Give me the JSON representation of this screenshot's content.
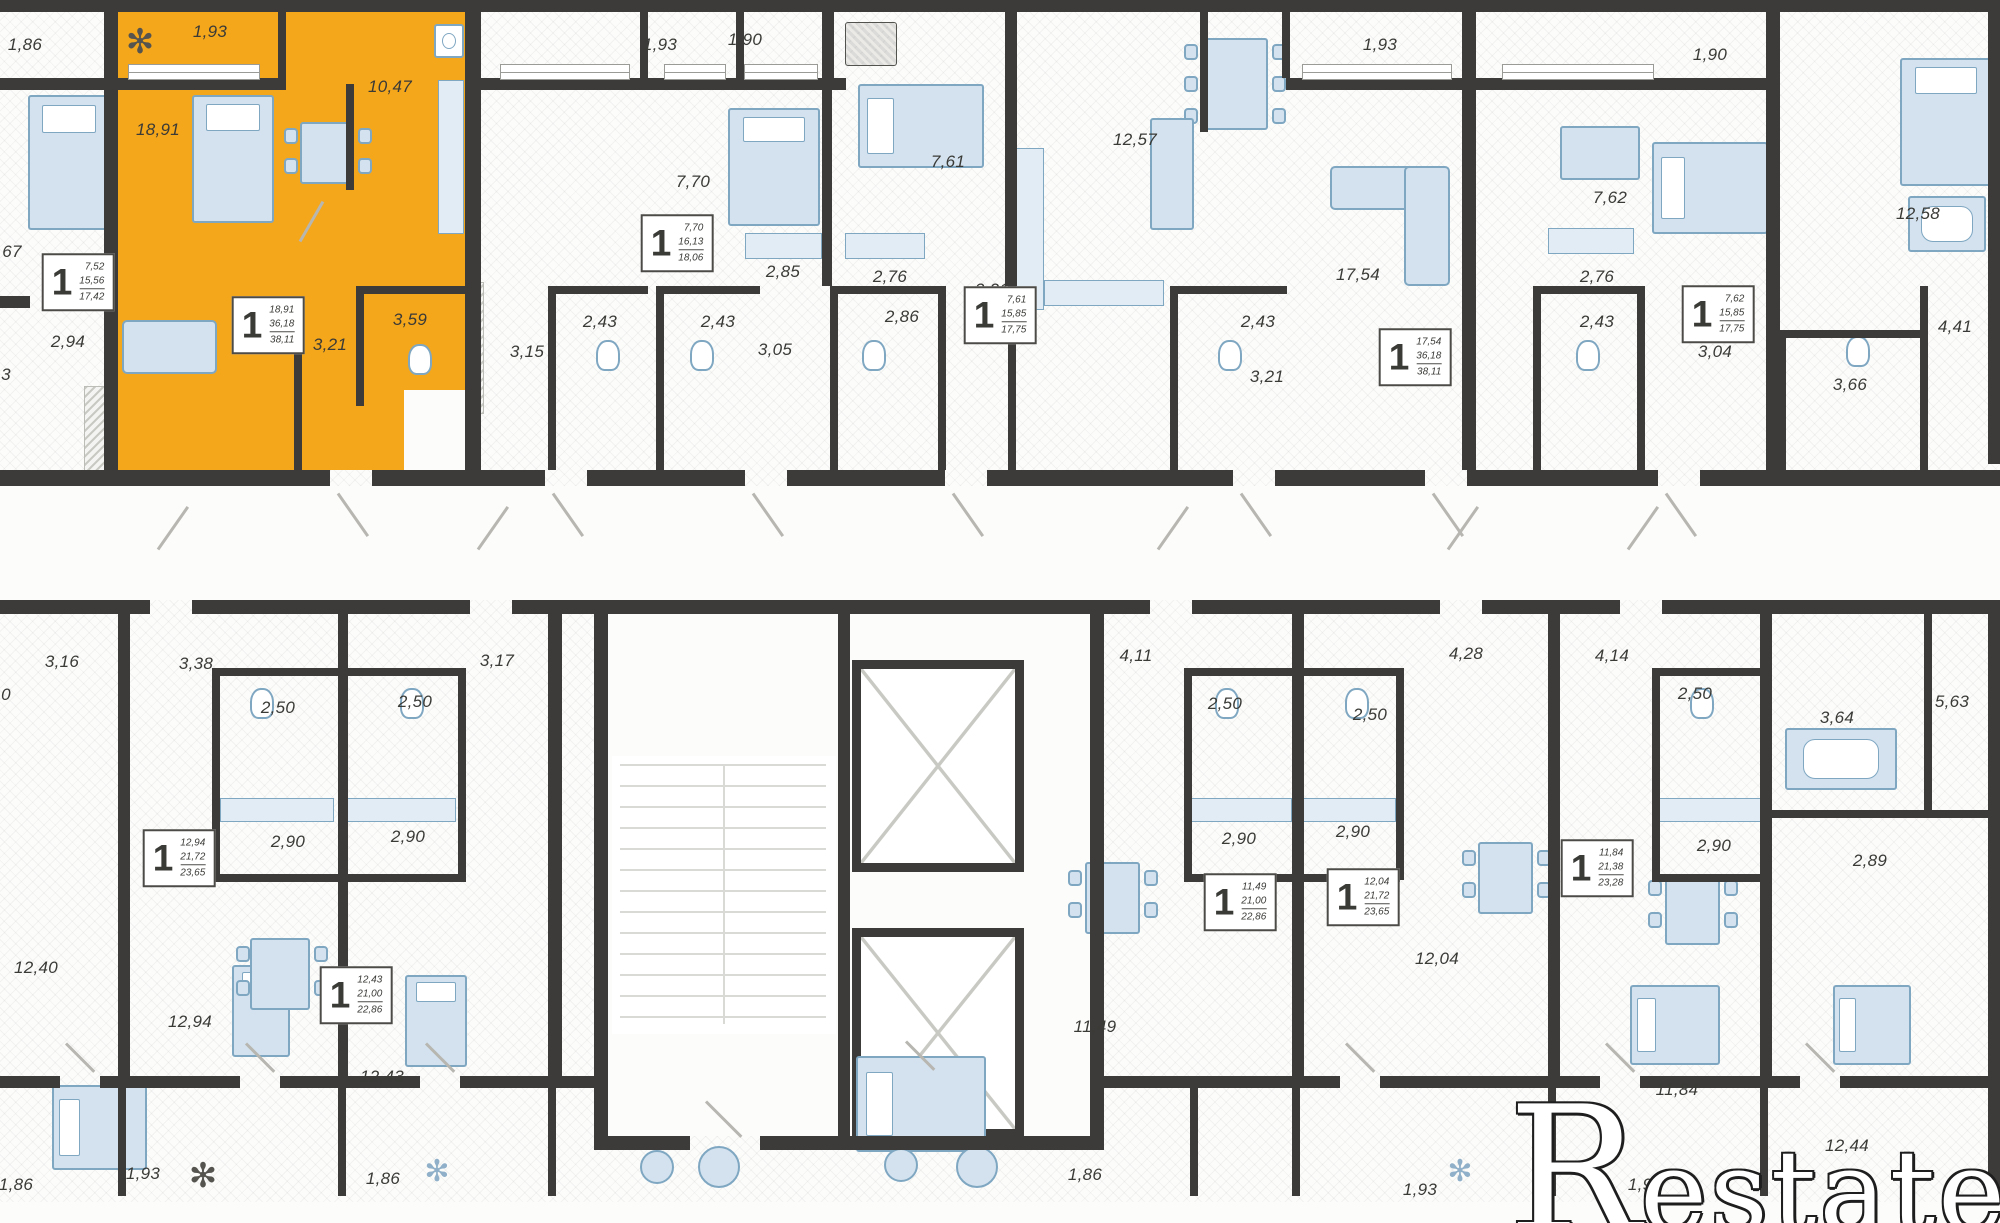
{
  "watermark": {
    "prefix": "R",
    "suffix": "estate"
  },
  "colors": {
    "highlight": "#F5A71B",
    "wall": "#3C3B39",
    "background": "#FCFCFB",
    "furniture_fill": "#D3E2EE",
    "furniture_stroke": "#7FA7C2",
    "counter_fill": "#E2ECF4",
    "text": "#3A3A37",
    "door_line": "#B8B6B0",
    "stair_line": "#D9D9D5",
    "watermark_fill": "#FFFFFF",
    "watermark_outline": "#1E1E1E"
  },
  "highlighted_unit": {
    "rooms": "1",
    "living_area": "18,91",
    "area_without_balcony": "36,18",
    "total_area": "38,11",
    "balcony": "1,93",
    "kitchen": "10,47",
    "hall": "3,21",
    "bathroom": "3,59"
  },
  "room_labels": [
    {
      "t": "1,86",
      "x": 25,
      "y": 45
    },
    {
      "t": "1,93",
      "x": 210,
      "y": 32
    },
    {
      "t": "10,47",
      "x": 390,
      "y": 87
    },
    {
      "t": "18,91",
      "x": 158,
      "y": 130
    },
    {
      "t": "67",
      "x": 12,
      "y": 252
    },
    {
      "t": "2,94",
      "x": 68,
      "y": 342
    },
    {
      "t": "3",
      "x": 6,
      "y": 375
    },
    {
      "t": "3,21",
      "x": 330,
      "y": 345
    },
    {
      "t": "3,59",
      "x": 410,
      "y": 320
    },
    {
      "t": "1,93",
      "x": 660,
      "y": 45
    },
    {
      "t": "7,70",
      "x": 693,
      "y": 182
    },
    {
      "t": "2,85",
      "x": 783,
      "y": 272
    },
    {
      "t": "2,43",
      "x": 600,
      "y": 322
    },
    {
      "t": "3,15",
      "x": 527,
      "y": 352
    },
    {
      "t": "1,90",
      "x": 745,
      "y": 40
    },
    {
      "t": "7,61",
      "x": 948,
      "y": 162
    },
    {
      "t": "2,76",
      "x": 890,
      "y": 277
    },
    {
      "t": "2,43",
      "x": 718,
      "y": 322
    },
    {
      "t": "3,05",
      "x": 775,
      "y": 350
    },
    {
      "t": "12,57",
      "x": 1135,
      "y": 140
    },
    {
      "t": "2,86",
      "x": 902,
      "y": 317
    },
    {
      "t": "3,21",
      "x": 992,
      "y": 290
    },
    {
      "t": "1,93",
      "x": 1380,
      "y": 45
    },
    {
      "t": "17,54",
      "x": 1358,
      "y": 275
    },
    {
      "t": "2,43",
      "x": 1258,
      "y": 322
    },
    {
      "t": "3,21",
      "x": 1267,
      "y": 377
    },
    {
      "t": "1,90",
      "x": 1710,
      "y": 55
    },
    {
      "t": "7,62",
      "x": 1610,
      "y": 198
    },
    {
      "t": "2,76",
      "x": 1597,
      "y": 277
    },
    {
      "t": "2,43",
      "x": 1597,
      "y": 322
    },
    {
      "t": "3,04",
      "x": 1715,
      "y": 352
    },
    {
      "t": "12,58",
      "x": 1918,
      "y": 214
    },
    {
      "t": "4,41",
      "x": 1955,
      "y": 327
    },
    {
      "t": "3,66",
      "x": 1850,
      "y": 385
    },
    {
      "t": "3,16",
      "x": 62,
      "y": 662
    },
    {
      "t": "3,38",
      "x": 196,
      "y": 664
    },
    {
      "t": "3,17",
      "x": 497,
      "y": 661
    },
    {
      "t": "0",
      "x": 6,
      "y": 695
    },
    {
      "t": "2,50",
      "x": 278,
      "y": 708
    },
    {
      "t": "2,50",
      "x": 415,
      "y": 702
    },
    {
      "t": "2,90",
      "x": 288,
      "y": 842
    },
    {
      "t": "2,90",
      "x": 408,
      "y": 837
    },
    {
      "t": "12,40",
      "x": 36,
      "y": 968
    },
    {
      "t": "12,94",
      "x": 190,
      "y": 1022
    },
    {
      "t": "12,43",
      "x": 382,
      "y": 1077
    },
    {
      "t": "4,11",
      "x": 1136,
      "y": 656
    },
    {
      "t": "4,28",
      "x": 1466,
      "y": 654
    },
    {
      "t": "2,50",
      "x": 1225,
      "y": 704
    },
    {
      "t": "2,50",
      "x": 1370,
      "y": 715
    },
    {
      "t": "2,90",
      "x": 1239,
      "y": 839
    },
    {
      "t": "2,90",
      "x": 1353,
      "y": 832
    },
    {
      "t": "12,04",
      "x": 1437,
      "y": 959
    },
    {
      "t": "11,49",
      "x": 1095,
      "y": 1027
    },
    {
      "t": "4,14",
      "x": 1612,
      "y": 656
    },
    {
      "t": "2,50",
      "x": 1695,
      "y": 694
    },
    {
      "t": "3,64",
      "x": 1837,
      "y": 718
    },
    {
      "t": "5,63",
      "x": 1952,
      "y": 702
    },
    {
      "t": "2,90",
      "x": 1714,
      "y": 846
    },
    {
      "t": "2,89",
      "x": 1870,
      "y": 861
    },
    {
      "t": "11,84",
      "x": 1677,
      "y": 1090
    },
    {
      "t": "12,44",
      "x": 1847,
      "y": 1146
    },
    {
      "t": "1,86",
      "x": 16,
      "y": 1185
    },
    {
      "t": "1,93",
      "x": 143,
      "y": 1174
    },
    {
      "t": "1,86",
      "x": 383,
      "y": 1179
    },
    {
      "t": "1,86",
      "x": 1085,
      "y": 1175
    },
    {
      "t": "1,93",
      "x": 1420,
      "y": 1190
    },
    {
      "t": "1,90",
      "x": 1645,
      "y": 1185
    }
  ],
  "unit_boxes": [
    {
      "x": 78,
      "y": 282,
      "rooms": "1",
      "v": [
        "7,52",
        "15,56",
        "17,42"
      ],
      "highlighted": false
    },
    {
      "x": 268,
      "y": 325,
      "rooms": "1",
      "v": [
        "18,91",
        "36,18",
        "38,11"
      ],
      "highlighted": true
    },
    {
      "x": 677,
      "y": 243,
      "rooms": "1",
      "v": [
        "7,70",
        "16,13",
        "18,06"
      ],
      "highlighted": false
    },
    {
      "x": 1000,
      "y": 315,
      "rooms": "1",
      "v": [
        "7,61",
        "15,85",
        "17,75"
      ],
      "highlighted": false
    },
    {
      "x": 1415,
      "y": 357,
      "rooms": "1",
      "v": [
        "17,54",
        "36,18",
        "38,11"
      ],
      "highlighted": false
    },
    {
      "x": 1718,
      "y": 314,
      "rooms": "1",
      "v": [
        "7,62",
        "15,85",
        "17,75"
      ],
      "highlighted": false
    },
    {
      "x": 179,
      "y": 858,
      "rooms": "1",
      "v": [
        "12,94",
        "21,72",
        "23,65"
      ],
      "highlighted": false
    },
    {
      "x": 356,
      "y": 995,
      "rooms": "1",
      "v": [
        "12,43",
        "21,00",
        "22,86"
      ],
      "highlighted": false
    },
    {
      "x": 1240,
      "y": 902,
      "rooms": "1",
      "v": [
        "11,49",
        "21,00",
        "22,86"
      ],
      "highlighted": false
    },
    {
      "x": 1363,
      "y": 897,
      "rooms": "1",
      "v": [
        "12,04",
        "21,72",
        "23,65"
      ],
      "highlighted": false
    },
    {
      "x": 1597,
      "y": 868,
      "rooms": "1",
      "v": [
        "11,84",
        "21,38",
        "23,28"
      ],
      "highlighted": false
    }
  ],
  "icons": [
    {
      "g": "✻",
      "x": 140,
      "y": 42,
      "dark": true
    },
    {
      "g": "✻",
      "x": 203,
      "y": 1176,
      "dark": true
    },
    {
      "g": "✻",
      "x": 437,
      "y": 1172,
      "dark": false
    },
    {
      "g": "✻",
      "x": 1460,
      "y": 1172,
      "dark": false
    }
  ]
}
